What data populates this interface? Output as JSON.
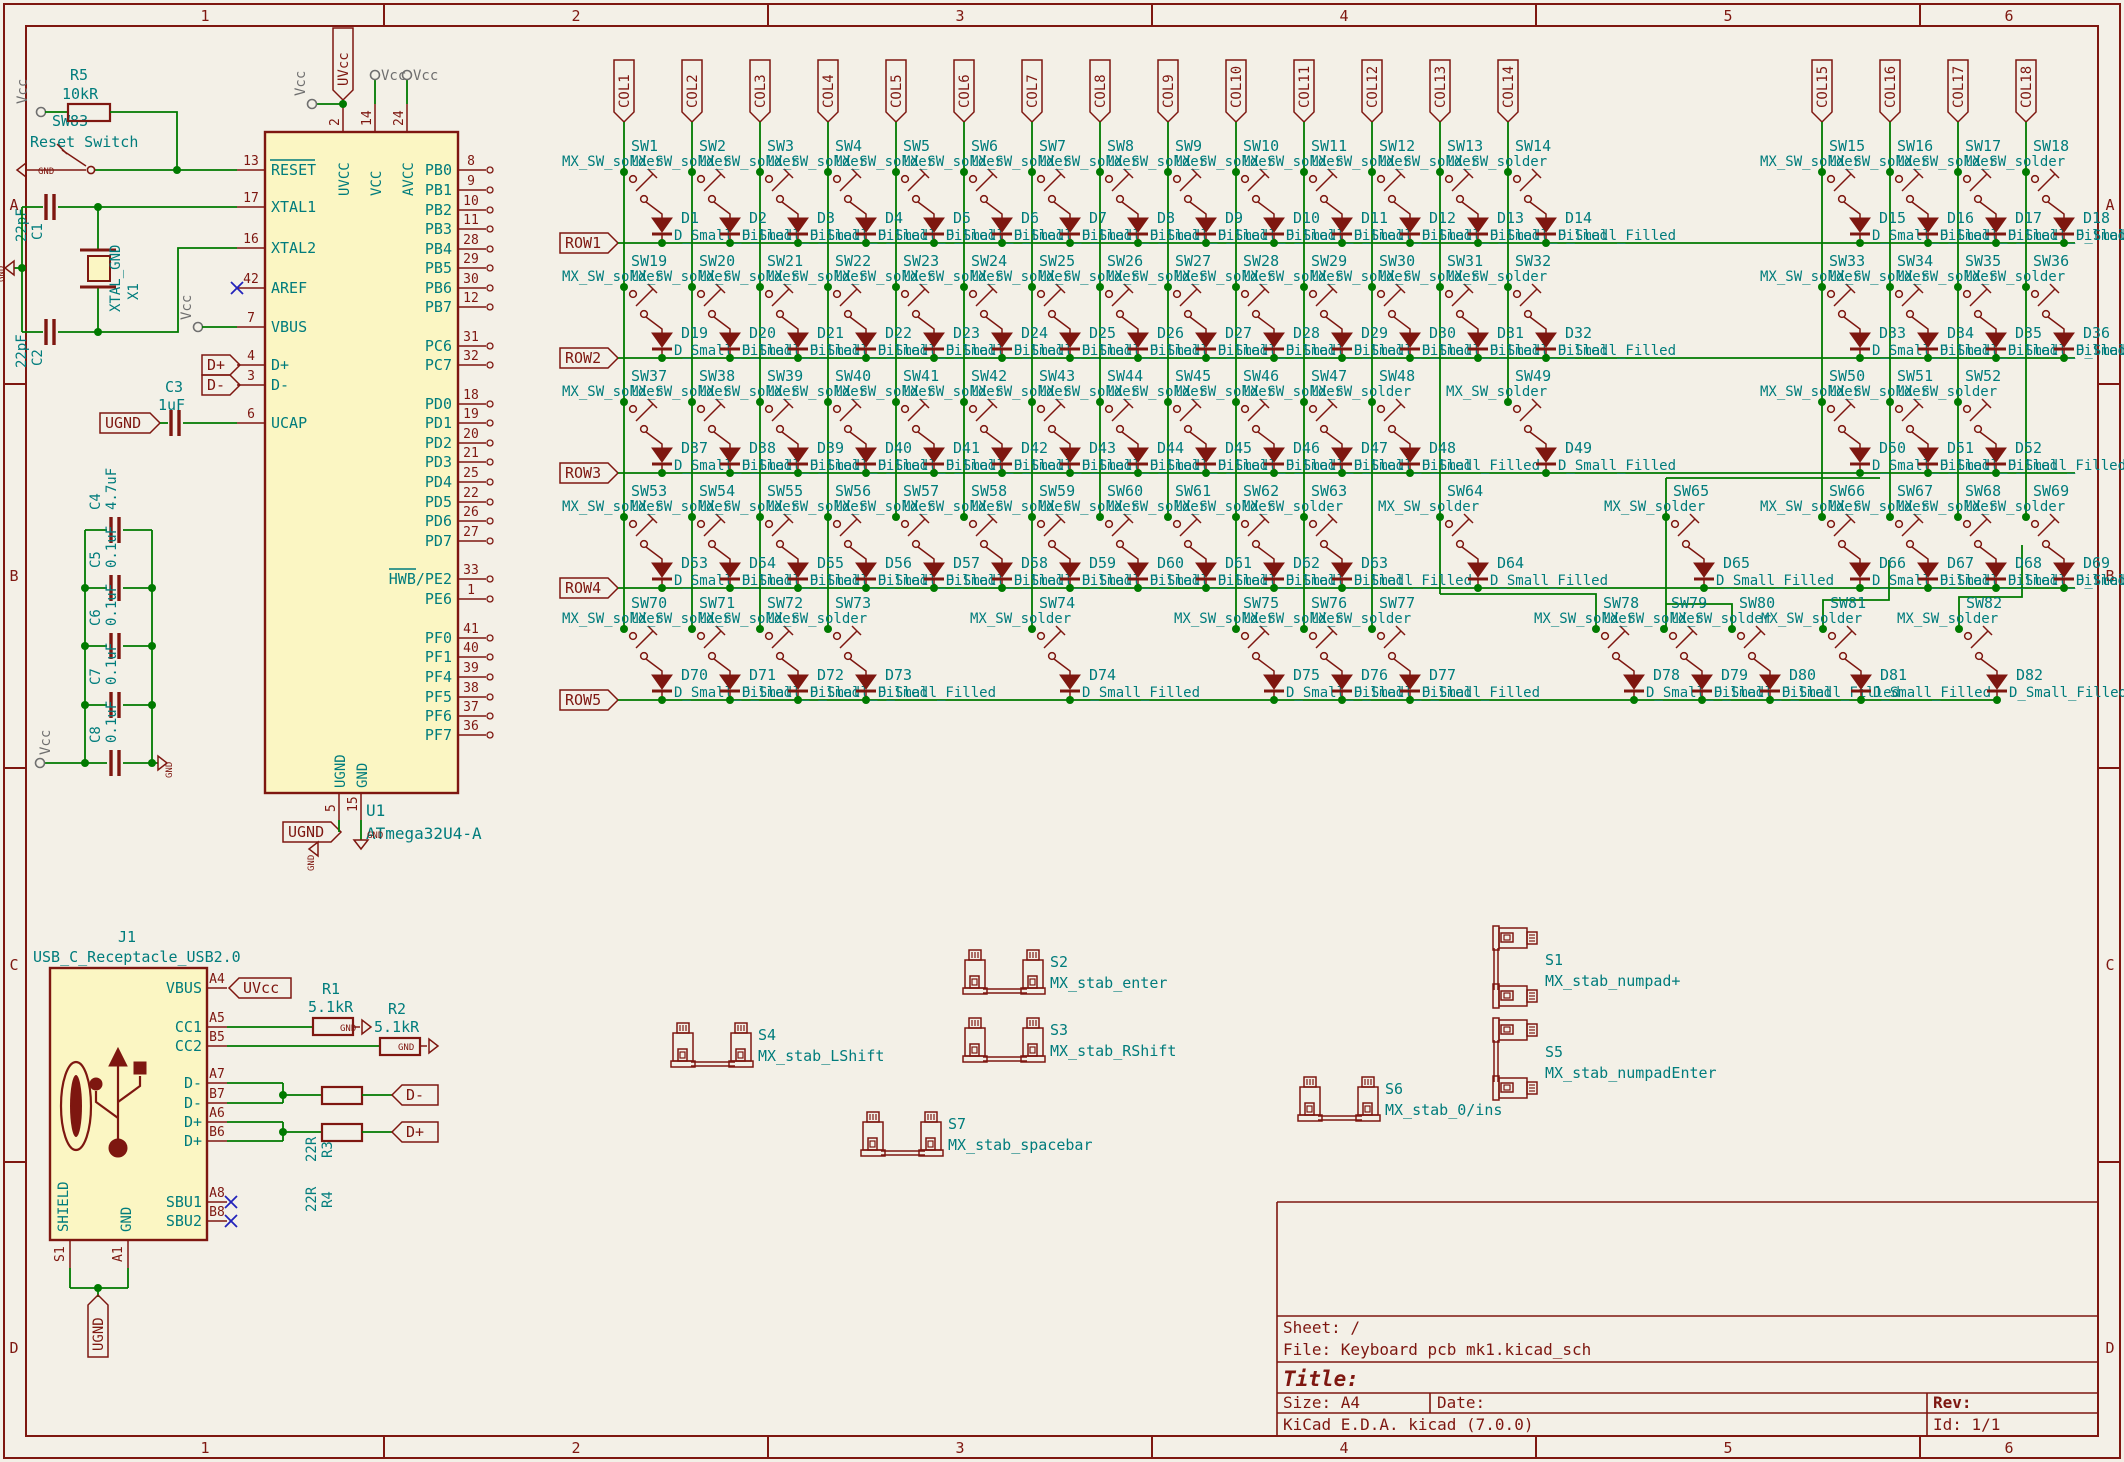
{
  "app": {
    "name": "KiCad Schematic Sheet"
  },
  "colors": {
    "background": "#F3F0E7",
    "symbol": "#7E1710",
    "symbol_fill": "#FBF6C3",
    "wire": "#007A00",
    "field_text": "#007C7C",
    "power_gray": "#6F6F6F",
    "noconnect_blue": "#2222BB"
  },
  "border": {
    "top_numbers": [
      "1",
      "2",
      "3",
      "4",
      "5",
      "6"
    ],
    "side_letters": [
      "A",
      "B",
      "C",
      "D"
    ]
  },
  "title_block": {
    "sheet": "Sheet: /",
    "file": "File: Keyboard pcb mk1.kicad_sch",
    "title_label": "Title:",
    "size_label": "Size: A4",
    "date_label": "Date:",
    "rev_label": "Rev:",
    "generator": "KiCad E.D.A.  kicad (7.0.0)",
    "id_label": "Id: 1/1"
  },
  "power": {
    "vcc": "Vcc",
    "gnd": "GND",
    "uvcc": "UVcc",
    "ugnd": "UGND"
  },
  "reset_circuit": {
    "r_ref": "R5",
    "r_value": "10kR",
    "sw_ref": "SW83",
    "sw_value": "Reset Switch",
    "reset_pin": "13"
  },
  "crystal_circuit": {
    "c1_ref": "C1",
    "c1_value": "22pF",
    "c2_ref": "C2",
    "c2_value": "22pF",
    "x1_ref": "X1",
    "x1_value": "XTAL_GND"
  },
  "ucap_circuit": {
    "c3_ref": "C3",
    "c3_value": "1uF"
  },
  "cap_bank": [
    {
      "ref": "C4",
      "value": "4.7uF",
      "y": 530
    },
    {
      "ref": "C5",
      "value": "0.1uF",
      "y": 588
    },
    {
      "ref": "C6",
      "value": "0.1uF",
      "y": 646
    },
    {
      "ref": "C7",
      "value": "0.1uF",
      "y": 705
    },
    {
      "ref": "C8",
      "value": "0.1uF",
      "y": 763
    }
  ],
  "mcu": {
    "ref": "U1",
    "value": "ATmega32U4-A",
    "top_pins": [
      {
        "num": "2",
        "name": "UVCC",
        "x": 343
      },
      {
        "num": "14",
        "name": "VCC",
        "x": 375
      },
      {
        "num": "24",
        "name": "AVCC",
        "x": 407
      }
    ],
    "bottom_pins": [
      {
        "num": "5",
        "name": "UGND",
        "x": 339
      },
      {
        "num": "15",
        "name": "GND",
        "x": 361
      }
    ],
    "left_pins": [
      {
        "num": "13",
        "name": "RESET",
        "y": 170,
        "bar": true
      },
      {
        "num": "17",
        "name": "XTAL1",
        "y": 207
      },
      {
        "num": "16",
        "name": "XTAL2",
        "y": 248
      },
      {
        "num": "42",
        "name": "AREF",
        "y": 288,
        "nc": true
      },
      {
        "num": "7",
        "name": "VBUS",
        "y": 327
      },
      {
        "num": "4",
        "name": "D+",
        "y": 365
      },
      {
        "num": "3",
        "name": "D-",
        "y": 385
      },
      {
        "num": "6",
        "name": "UCAP",
        "y": 423
      }
    ],
    "right_pins": [
      {
        "num": "8",
        "name": "PB0",
        "y": 170
      },
      {
        "num": "9",
        "name": "PB1",
        "y": 190
      },
      {
        "num": "10",
        "name": "PB2",
        "y": 210
      },
      {
        "num": "11",
        "name": "PB3",
        "y": 229
      },
      {
        "num": "28",
        "name": "PB4",
        "y": 249
      },
      {
        "num": "29",
        "name": "PB5",
        "y": 268
      },
      {
        "num": "30",
        "name": "PB6",
        "y": 288
      },
      {
        "num": "12",
        "name": "PB7",
        "y": 307
      },
      {
        "num": "31",
        "name": "PC6",
        "y": 346
      },
      {
        "num": "32",
        "name": "PC7",
        "y": 365
      },
      {
        "num": "18",
        "name": "PD0",
        "y": 404
      },
      {
        "num": "19",
        "name": "PD1",
        "y": 423
      },
      {
        "num": "20",
        "name": "PD2",
        "y": 443
      },
      {
        "num": "21",
        "name": "PD3",
        "y": 462
      },
      {
        "num": "25",
        "name": "PD4",
        "y": 482
      },
      {
        "num": "22",
        "name": "PD5",
        "y": 502
      },
      {
        "num": "26",
        "name": "PD6",
        "y": 521
      },
      {
        "num": "27",
        "name": "PD7",
        "y": 541
      },
      {
        "num": "33",
        "name": "HWB/PE2",
        "y": 579,
        "barpart": "HWB"
      },
      {
        "num": "1",
        "name": "PE6",
        "y": 599
      },
      {
        "num": "41",
        "name": "PF0",
        "y": 638
      },
      {
        "num": "40",
        "name": "PF1",
        "y": 657
      },
      {
        "num": "39",
        "name": "PF4",
        "y": 677
      },
      {
        "num": "38",
        "name": "PF5",
        "y": 697
      },
      {
        "num": "37",
        "name": "PF6",
        "y": 716
      },
      {
        "num": "36",
        "name": "PF7",
        "y": 735
      }
    ],
    "hier_labels": {
      "dplus": "D+",
      "dminus": "D-"
    }
  },
  "usb": {
    "ref": "J1",
    "value": "USB_C_Receptacle_USB2.0",
    "right_pins": [
      {
        "id": "A4",
        "name": "VBUS",
        "y": 988
      },
      {
        "id": "A5",
        "name": "CC1",
        "y": 1027
      },
      {
        "id": "B5",
        "name": "CC2",
        "y": 1046
      },
      {
        "id": "A7",
        "name": "D-",
        "y": 1083
      },
      {
        "id": "B7",
        "name": "D-",
        "y": 1103
      },
      {
        "id": "A6",
        "name": "D+",
        "y": 1122
      },
      {
        "id": "B6",
        "name": "D+",
        "y": 1141
      },
      {
        "id": "A8",
        "name": "SBU1",
        "y": 1202,
        "nc": true
      },
      {
        "id": "B8",
        "name": "SBU2",
        "y": 1221,
        "nc": true
      }
    ],
    "bottom_pins": [
      {
        "id": "S1",
        "name": "SHIELD",
        "x": 70
      },
      {
        "id": "A1",
        "name": "GND",
        "x": 128
      }
    ],
    "r1": {
      "ref": "R1",
      "value": "5.1kR"
    },
    "r2": {
      "ref": "R2",
      "value": "5.1kR"
    },
    "r3": {
      "ref": "R3",
      "value": "22R"
    },
    "r4": {
      "ref": "R4",
      "value": "22R"
    },
    "labels": {
      "uvcc": "UVcc",
      "dminus": "D-",
      "dplus": "D+",
      "ugnd": "UGND"
    }
  },
  "matrix": {
    "sw_value": "MX_SW_solder",
    "d_value": "D_Small_Filled",
    "cols": [
      {
        "label": "COL1",
        "x": 624,
        "end": 629
      },
      {
        "label": "COL2",
        "x": 692,
        "end": 629
      },
      {
        "label": "COL3",
        "x": 760,
        "end": 629
      },
      {
        "label": "COL4",
        "x": 828,
        "end": 629
      },
      {
        "label": "COL5",
        "x": 896,
        "end": 517
      },
      {
        "label": "COL6",
        "x": 964,
        "end": 517
      },
      {
        "label": "COL7",
        "x": 1032,
        "end": 629
      },
      {
        "label": "COL8",
        "x": 1100,
        "end": 517
      },
      {
        "label": "COL9",
        "x": 1168,
        "end": 517
      },
      {
        "label": "COL10",
        "x": 1236,
        "end": 629
      },
      {
        "label": "COL11",
        "x": 1304,
        "end": 629
      },
      {
        "label": "COL12",
        "x": 1372,
        "end": 629
      },
      {
        "label": "COL13",
        "x": 1440,
        "end": 594
      },
      {
        "label": "COL14",
        "x": 1508,
        "end": 402
      },
      {
        "label": "COL15",
        "x": 1822,
        "end": 517
      },
      {
        "label": "COL16",
        "x": 1890,
        "end": 517
      },
      {
        "label": "COL17",
        "x": 1958,
        "end": 517
      },
      {
        "label": "COL18",
        "x": 2026,
        "end": 517
      }
    ],
    "jogs": [
      [
        [
          1440,
          594
        ],
        [
          1596,
          594
        ],
        [
          1596,
          629
        ]
      ],
      [
        [
          1666,
          478
        ],
        [
          1880,
          478
        ]
      ],
      [
        [
          1666,
          478
        ],
        [
          1666,
          629
        ]
      ],
      [
        [
          1732,
          629
        ],
        [
          1732,
          604
        ],
        [
          1666,
          604
        ]
      ],
      [
        [
          1823,
          629
        ],
        [
          1823,
          600
        ],
        [
          1889,
          600
        ],
        [
          1889,
          560
        ]
      ],
      [
        [
          1959,
          629
        ],
        [
          1959,
          597
        ],
        [
          2022,
          597
        ],
        [
          2022,
          545
        ]
      ]
    ],
    "rows": [
      {
        "label": "ROW1",
        "y": 243,
        "bus_end": 2075,
        "cells": [
          {
            "sw": "SW1",
            "d": "D1",
            "x": 624
          },
          {
            "sw": "SW2",
            "d": "D2",
            "x": 692
          },
          {
            "sw": "SW3",
            "d": "D3",
            "x": 760
          },
          {
            "sw": "SW4",
            "d": "D4",
            "x": 828
          },
          {
            "sw": "SW5",
            "d": "D5",
            "x": 896
          },
          {
            "sw": "SW6",
            "d": "D6",
            "x": 964
          },
          {
            "sw": "SW7",
            "d": "D7",
            "x": 1032
          },
          {
            "sw": "SW8",
            "d": "D8",
            "x": 1100
          },
          {
            "sw": "SW9",
            "d": "D9",
            "x": 1168
          },
          {
            "sw": "SW10",
            "d": "D10",
            "x": 1236
          },
          {
            "sw": "SW11",
            "d": "D11",
            "x": 1304
          },
          {
            "sw": "SW12",
            "d": "D12",
            "x": 1372
          },
          {
            "sw": "SW13",
            "d": "D13",
            "x": 1440
          },
          {
            "sw": "SW14",
            "d": "D14",
            "x": 1508
          },
          {
            "sw": "SW15",
            "d": "D15",
            "x": 1822
          },
          {
            "sw": "SW16",
            "d": "D16",
            "x": 1890
          },
          {
            "sw": "SW17",
            "d": "D17",
            "x": 1958
          },
          {
            "sw": "SW18",
            "d": "D18",
            "x": 2026
          }
        ]
      },
      {
        "label": "ROW2",
        "y": 358,
        "bus_end": 2075,
        "cells": [
          {
            "sw": "SW19",
            "d": "D19",
            "x": 624
          },
          {
            "sw": "SW20",
            "d": "D20",
            "x": 692
          },
          {
            "sw": "SW21",
            "d": "D21",
            "x": 760
          },
          {
            "sw": "SW22",
            "d": "D22",
            "x": 828
          },
          {
            "sw": "SW23",
            "d": "D23",
            "x": 896
          },
          {
            "sw": "SW24",
            "d": "D24",
            "x": 964
          },
          {
            "sw": "SW25",
            "d": "D25",
            "x": 1032
          },
          {
            "sw": "SW26",
            "d": "D26",
            "x": 1100
          },
          {
            "sw": "SW27",
            "d": "D27",
            "x": 1168
          },
          {
            "sw": "SW28",
            "d": "D28",
            "x": 1236
          },
          {
            "sw": "SW29",
            "d": "D29",
            "x": 1304
          },
          {
            "sw": "SW30",
            "d": "D30",
            "x": 1372
          },
          {
            "sw": "SW31",
            "d": "D31",
            "x": 1440
          },
          {
            "sw": "SW32",
            "d": "D32",
            "x": 1508
          },
          {
            "sw": "SW33",
            "d": "D33",
            "x": 1822
          },
          {
            "sw": "SW34",
            "d": "D34",
            "x": 1890
          },
          {
            "sw": "SW35",
            "d": "D35",
            "x": 1958
          },
          {
            "sw": "SW36",
            "d": "D36",
            "x": 2026
          }
        ]
      },
      {
        "label": "ROW3",
        "y": 473,
        "bus_end": 2075,
        "cells": [
          {
            "sw": "SW37",
            "d": "D37",
            "x": 624
          },
          {
            "sw": "SW38",
            "d": "D38",
            "x": 692
          },
          {
            "sw": "SW39",
            "d": "D39",
            "x": 760
          },
          {
            "sw": "SW40",
            "d": "D40",
            "x": 828
          },
          {
            "sw": "SW41",
            "d": "D41",
            "x": 896
          },
          {
            "sw": "SW42",
            "d": "D42",
            "x": 964
          },
          {
            "sw": "SW43",
            "d": "D43",
            "x": 1032
          },
          {
            "sw": "SW44",
            "d": "D44",
            "x": 1100
          },
          {
            "sw": "SW45",
            "d": "D45",
            "x": 1168
          },
          {
            "sw": "SW46",
            "d": "D46",
            "x": 1236
          },
          {
            "sw": "SW47",
            "d": "D47",
            "x": 1304
          },
          {
            "sw": "SW48",
            "d": "D48",
            "x": 1372
          },
          {
            "sw": "SW49",
            "d": "D49",
            "x": 1508
          },
          {
            "sw": "SW50",
            "d": "D50",
            "x": 1822
          },
          {
            "sw": "SW51",
            "d": "D51",
            "x": 1890
          },
          {
            "sw": "SW52",
            "d": "D52",
            "x": 1958
          }
        ]
      },
      {
        "label": "ROW4",
        "y": 588,
        "bus_end": 2075,
        "cells": [
          {
            "sw": "SW53",
            "d": "D53",
            "x": 624
          },
          {
            "sw": "SW54",
            "d": "D54",
            "x": 692
          },
          {
            "sw": "SW55",
            "d": "D55",
            "x": 760
          },
          {
            "sw": "SW56",
            "d": "D56",
            "x": 828
          },
          {
            "sw": "SW57",
            "d": "D57",
            "x": 896
          },
          {
            "sw": "SW58",
            "d": "D58",
            "x": 964
          },
          {
            "sw": "SW59",
            "d": "D59",
            "x": 1032
          },
          {
            "sw": "SW60",
            "d": "D60",
            "x": 1100
          },
          {
            "sw": "SW61",
            "d": "D61",
            "x": 1168
          },
          {
            "sw": "SW62",
            "d": "D62",
            "x": 1236
          },
          {
            "sw": "SW63",
            "d": "D63",
            "x": 1304
          },
          {
            "sw": "SW64",
            "d": "D64",
            "x": 1440
          },
          {
            "sw": "SW65",
            "d": "D65",
            "x": 1666
          },
          {
            "sw": "SW66",
            "d": "D66",
            "x": 1822
          },
          {
            "sw": "SW67",
            "d": "D67",
            "x": 1890
          },
          {
            "sw": "SW68",
            "d": "D68",
            "x": 1958
          },
          {
            "sw": "SW69",
            "d": "D69",
            "x": 2026
          }
        ]
      },
      {
        "label": "ROW5",
        "y": 700,
        "bus_end": 1997,
        "cells": [
          {
            "sw": "SW70",
            "d": "D70",
            "x": 624
          },
          {
            "sw": "SW71",
            "d": "D71",
            "x": 692
          },
          {
            "sw": "SW72",
            "d": "D72",
            "x": 760
          },
          {
            "sw": "SW73",
            "d": "D73",
            "x": 828
          },
          {
            "sw": "SW74",
            "d": "D74",
            "x": 1032
          },
          {
            "sw": "SW75",
            "d": "D75",
            "x": 1236
          },
          {
            "sw": "SW76",
            "d": "D76",
            "x": 1304
          },
          {
            "sw": "SW77",
            "d": "D77",
            "x": 1372
          },
          {
            "sw": "SW78",
            "d": "D78",
            "x": 1596
          },
          {
            "sw": "SW79",
            "d": "D79",
            "x": 1664
          },
          {
            "sw": "SW80",
            "d": "D80",
            "x": 1732
          },
          {
            "sw": "SW81",
            "d": "D81",
            "x": 1823
          },
          {
            "sw": "SW82",
            "d": "D82",
            "x": 1959
          }
        ]
      }
    ]
  },
  "stabs": [
    {
      "ref": "S2",
      "value": "MX_stab_enter",
      "x": 965,
      "y": 950,
      "o": "h",
      "tx": 1050,
      "ty": 967
    },
    {
      "ref": "S3",
      "value": "MX_stab_RShift",
      "x": 965,
      "y": 1018,
      "o": "h",
      "tx": 1050,
      "ty": 1035
    },
    {
      "ref": "S4",
      "value": "MX_stab_LShift",
      "x": 673,
      "y": 1023,
      "o": "h",
      "tx": 758,
      "ty": 1040
    },
    {
      "ref": "S7",
      "value": "MX_stab_spacebar",
      "x": 863,
      "y": 1112,
      "o": "h",
      "tx": 948,
      "ty": 1129
    },
    {
      "ref": "S6",
      "value": "MX_stab_0/ins",
      "x": 1300,
      "y": 1077,
      "o": "h",
      "tx": 1385,
      "ty": 1094
    },
    {
      "ref": "S1",
      "value": "MX_stab_numpad+",
      "x": 1493,
      "y": 928,
      "o": "v",
      "tx": 1545,
      "ty": 965
    },
    {
      "ref": "S5",
      "value": "MX_stab_numpadEnter",
      "x": 1493,
      "y": 1020,
      "o": "v",
      "tx": 1545,
      "ty": 1057
    }
  ]
}
